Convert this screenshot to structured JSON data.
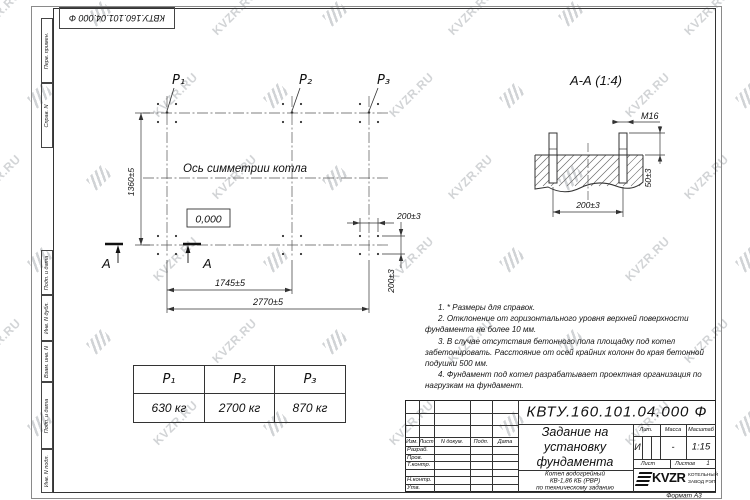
{
  "watermark": {
    "text": "KVZR.RU"
  },
  "frame": {
    "stamp_rotated": "КВТУ.160.101.04.000 Ф",
    "margin_top": [
      "Перв. примен.",
      "Справ. N"
    ],
    "margin_bottom": [
      "Подп. и дата",
      "Инв. N дубл.",
      "Взам. инв. N",
      "Подп. и дата",
      "Инв. N подл."
    ],
    "format_note": "Формат А3"
  },
  "plan": {
    "p_labels": [
      "P₁",
      "P₂",
      "P₃"
    ],
    "axis_label": "Ось симметрии котла",
    "level_mark": "0,000",
    "dim_height": "1360±5",
    "dim_span_inner": "1745±5",
    "dim_span_outer": "2770±5",
    "dim_bolt_x": "200±3",
    "dim_bolt_y": "200±3",
    "section_letter_left": "А",
    "section_letter_right": "А"
  },
  "section_view": {
    "title": "А-А (1:4)",
    "bolt_thread": "M16",
    "dim_width": "200±3",
    "dim_height": "50±3"
  },
  "notes": [
    "1. * Размеры для справок.",
    "2. Отклонение от горизонтального уровня верхней поверхности фундамента не более 10 мм.",
    "3. В случае отсутствия бетонного пола площадку под котел забетонировать. Расстояние от осей крайних колонн до края бетонной подушки 500 мм.",
    "4. Фундамент под котел разрабатывает проектная организация по нагрузкам на фундамент."
  ],
  "load_table": {
    "headers": [
      "P₁",
      "P₂",
      "P₃"
    ],
    "values": [
      "630 кг",
      "2700 кг",
      "870 кг"
    ]
  },
  "title_block": {
    "designation": "КВТУ.160.101.04.000 Ф",
    "doc_title_lines": [
      "Задание на",
      "установку",
      "фундамента"
    ],
    "product_lines": [
      "Котел водогрейный",
      "КВ-1,86 КБ (РВР)",
      "по техническому заданию"
    ],
    "header_cols": [
      "Изм.",
      "Лист",
      "N докум.",
      "Подп.",
      "Дата"
    ],
    "row_labels": [
      "Разраб.",
      "Пров.",
      "Т.контр.",
      "Н.контр.",
      "Утв."
    ],
    "lit_label": "Лит.",
    "mass_label": "Масса",
    "scale_label": "Масштаб",
    "lit_value": "И",
    "mass_value": "-",
    "scale_value": "1:15",
    "sheet_label": "Лист",
    "sheets_label": "Листов",
    "sheets_value": "1",
    "logo_text": "KVZR",
    "logo_sub1": "КОТЕЛЬНЫЙ",
    "logo_sub2": "ЗАВОД РЭП"
  }
}
